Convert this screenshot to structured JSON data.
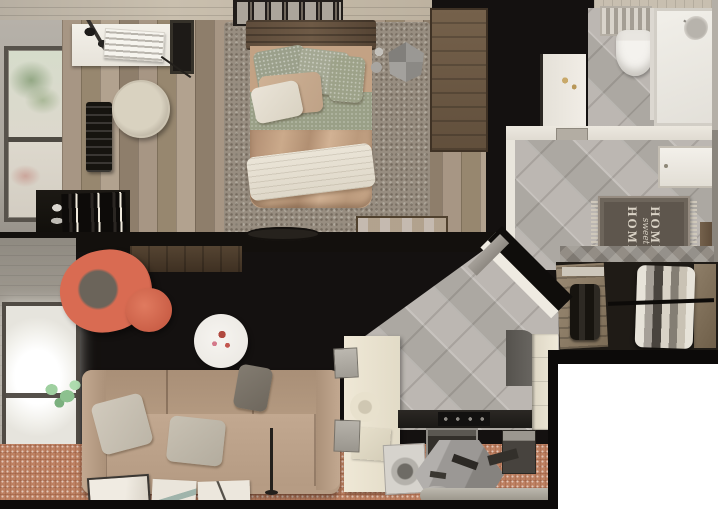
{
  "hallway": {
    "mat_line1": "HOME",
    "mat_line2": "sweet",
    "mat_line3": "HOME"
  },
  "rooms": {
    "bedroom": [
      "double-bed",
      "rustic-headboard",
      "sage-pillows",
      "tan-duvet",
      "white-sheet",
      "shag-rug",
      "picture-frames",
      "white-desk",
      "typewriter",
      "desk-lamp",
      "wall-mirror",
      "hanging-chair",
      "black-radiator",
      "street-window",
      "black-desk",
      "books",
      "wood-crate",
      "wardrobe",
      "faceted-stool",
      "silver-decor"
    ],
    "bathroom": [
      "toilet",
      "towel-radiator",
      "shower-tray",
      "shower-head",
      "vanity",
      "gold-faucet",
      "gray-diagonal-tiles",
      "door"
    ],
    "hallway": [
      "diagonal-tiles",
      "home-sweet-home-mat",
      "entry-door",
      "wood-shelf",
      "diagonal-wall",
      "open-door-leaf"
    ],
    "closet": [
      "argyle-wall",
      "open-doors",
      "hanging-clothes",
      "clothes-rail",
      "shoe-shelf",
      "boots"
    ],
    "living_room": [
      "diagonal-plank-floor",
      "bright-window",
      "green-plant",
      "coral-swivel-chair",
      "coral-ottoman",
      "round-coffee-table",
      "tan-sofa",
      "sofa-pillows",
      "terracotta-rug",
      "floor-posters",
      "floor-lamp",
      "wood-shelf"
    ],
    "kitchen": [
      "cream-counter",
      "dark-countertop",
      "stove",
      "oven",
      "faceted-hood",
      "washing-machine",
      "fridge-unit",
      "gray-armchair",
      "microwave",
      "utensils",
      "rolled-mat",
      "plate",
      "cutting-board"
    ]
  },
  "colors": {
    "wall_dark": "#141110",
    "bedroom_floor": "#a79684",
    "bedroom_rug": "#978d80",
    "bed_duvet": "#cbaa8b",
    "bed_sheet": "#ebe5d8",
    "pillow_sage": "#9aa087",
    "wardrobe_wood": "#7c6a55",
    "tile": "#b7b2ac",
    "porcelain": "#f4f2ee",
    "gold": "#c9a96a",
    "mat": "#5e564d",
    "mat_text": "#dad3c6",
    "closet_dark": "#1f1b16",
    "wood_diag": "#9c8a77",
    "chair_red": "#d96b52",
    "sofa": "#b69c84",
    "sofa_pillow": "#d1cabd",
    "rug_terracotta": "#bd8061",
    "plant_green": "#9fd0a0",
    "counter_cream": "#efe8d6",
    "countertop": "#1b1916",
    "hood_gray": "#9b9895",
    "appliance": "#d6d3cd",
    "white_area": "#ffffff"
  }
}
